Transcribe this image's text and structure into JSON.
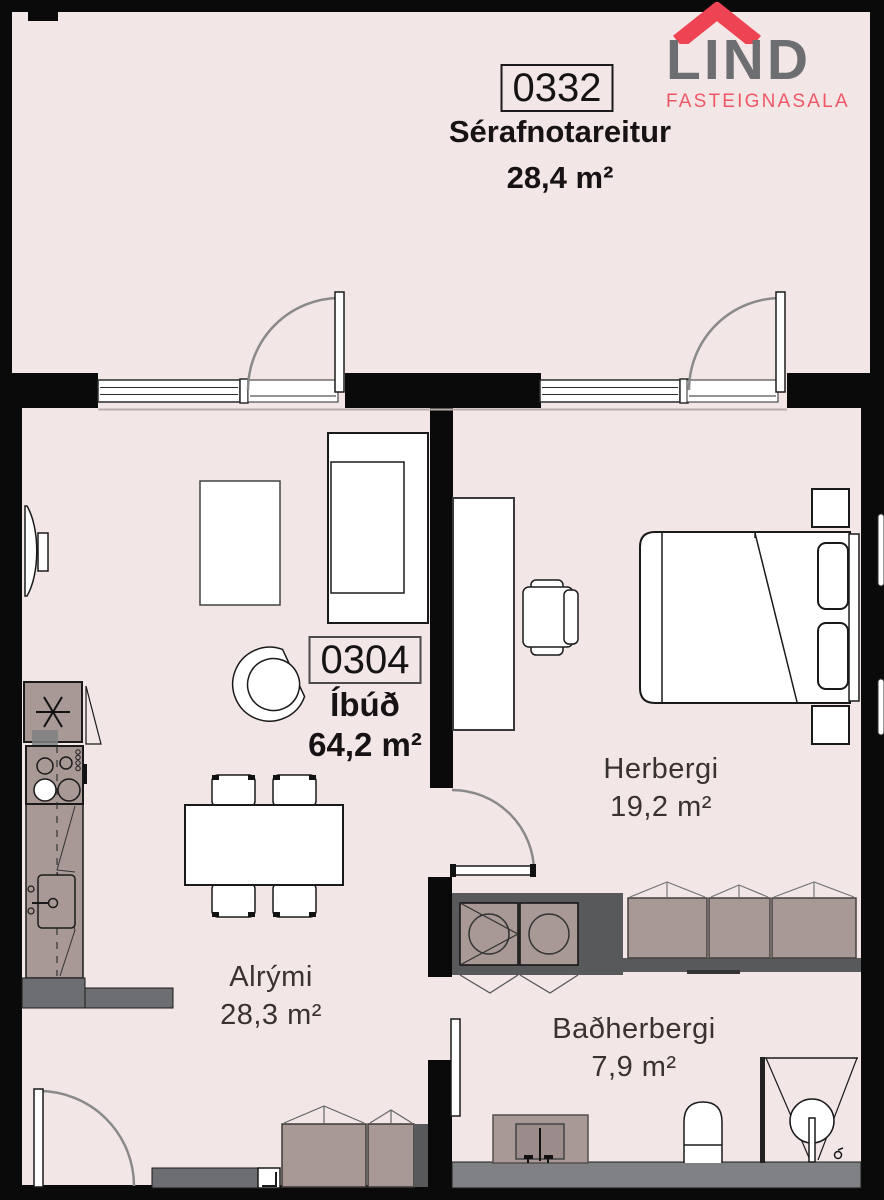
{
  "logo": {
    "name": "LIND",
    "subtitle": "FASTEIGNASALA",
    "roof_icon": "roof-icon",
    "gray": "#6d6e71",
    "red": "#ee4353",
    "pink": "#ef5766"
  },
  "plan": {
    "serafnotareitur": {
      "unit": "0332",
      "name": "Sérafnotareitur",
      "size": "28,4 m²"
    },
    "ibud": {
      "unit": "0304",
      "name": "Íbúð",
      "size": "64,2 m²"
    },
    "rooms": [
      {
        "name": "Herbergi",
        "size": "19,2 m²"
      },
      {
        "name": "Alrými",
        "size": "28,3 m²"
      },
      {
        "name": "Baðherbergi",
        "size": "7,9 m²"
      }
    ]
  },
  "colors": {
    "background": "#f2e7e6",
    "wall": "#0b0a0a",
    "furniture_mauve": "#a89896",
    "dark_gray": "#58595b",
    "mid_gray": "#6d6e71",
    "floor_gray": "#808184",
    "line": "#1a1a1a",
    "door_arc": "#8a8a8a"
  }
}
